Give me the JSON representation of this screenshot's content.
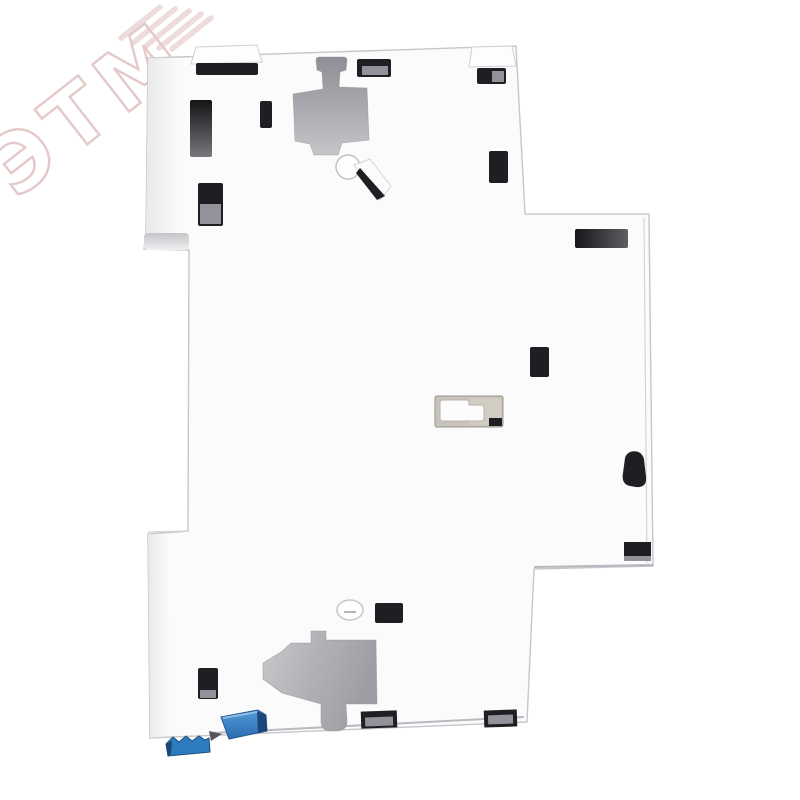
{
  "watermark": {
    "text": "ЭТМ"
  },
  "colors": {
    "background": "#ffffff",
    "body": "#fbfbfc",
    "edge": "#c9c9cd",
    "cutout_dark": "#90909a",
    "cutout_light": "#c7c7ca",
    "slot": "#1f1f23",
    "slot_floor": "#92929a",
    "recess": "#c8c4bb",
    "clip_blue": "#2e7cc0",
    "clip_blue_dark": "#1d4577",
    "watermark_pink": "#e5c9c9"
  }
}
